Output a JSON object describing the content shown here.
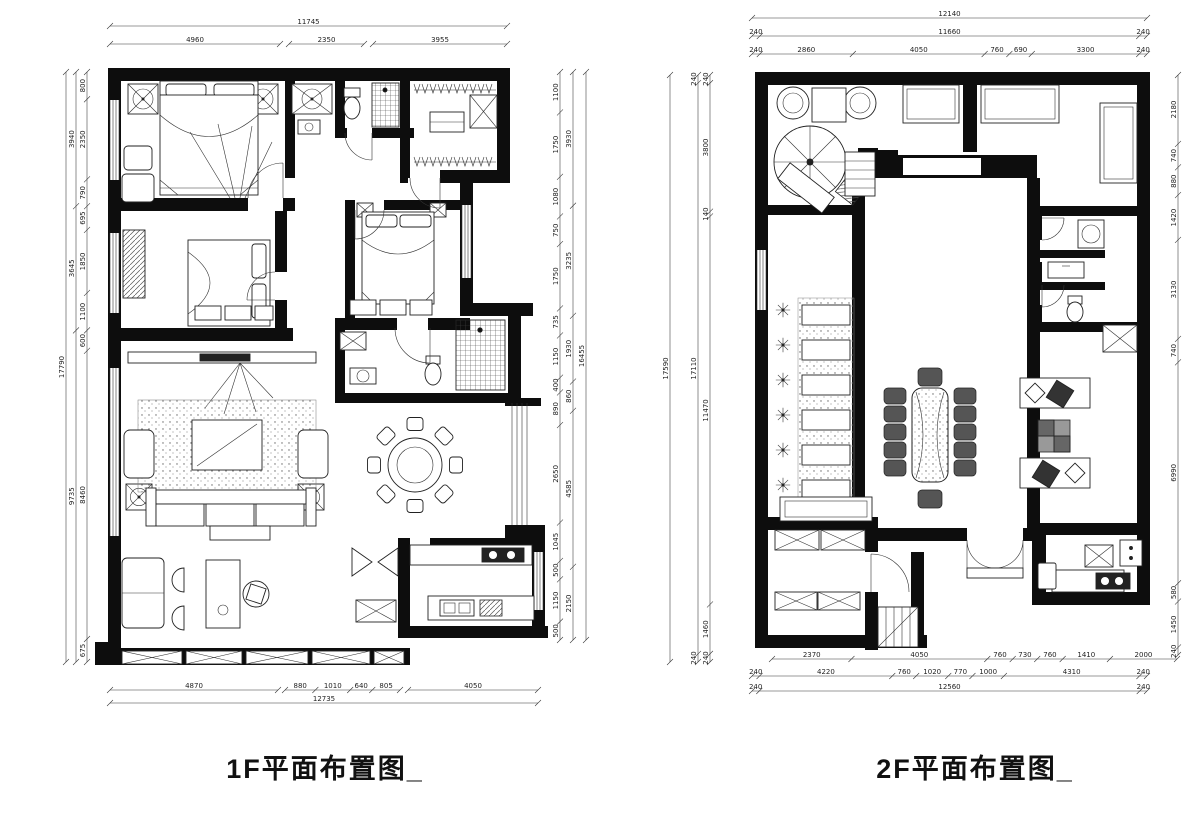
{
  "canvas": {
    "width": 1200,
    "height": 815,
    "background": "#ffffff",
    "ink": "#0d0d0d"
  },
  "plans": [
    {
      "id": "f1",
      "title": "1F平面布置图_",
      "dimension_chains": {
        "top": [
          {
            "y": 26,
            "a": 110,
            "b": 507,
            "labels": [
              "11745"
            ]
          },
          {
            "y": 44,
            "a": 110,
            "b": 280,
            "labels": [
              "4960"
            ]
          },
          {
            "y": 44,
            "a": 289,
            "b": 364,
            "labels": [
              "2350"
            ]
          },
          {
            "y": 44,
            "a": 373,
            "b": 507,
            "labels": [
              "3955"
            ]
          }
        ],
        "bottom": [
          {
            "y": 690,
            "a": 110,
            "b": 278,
            "labels": [
              "4870"
            ]
          },
          {
            "y": 690,
            "a": 285,
            "b": 400,
            "labels": [
              "880",
              "1010",
              "640",
              "805"
            ]
          },
          {
            "y": 690,
            "a": 408,
            "b": 538,
            "labels": [
              "4050"
            ]
          },
          {
            "y": 703,
            "a": 110,
            "b": 538,
            "labels": [
              "12735"
            ]
          }
        ],
        "left": [
          {
            "x": 66,
            "a": 72,
            "b": 662,
            "labels": [
              "17790"
            ]
          },
          {
            "x": 76,
            "a": 72,
            "b": 662,
            "labels": [
              "3940",
              "3645",
              "9735"
            ]
          },
          {
            "x": 87,
            "a": 72,
            "b": 662,
            "labels": [
              "800",
              "2350",
              "790",
              "695",
              "1850",
              "1100",
              "600",
              "8460",
              "675"
            ]
          }
        ],
        "right": [
          {
            "x": 560,
            "a": 72,
            "b": 640,
            "labels": [
              "1100",
              "1750",
              "1080",
              "750",
              "1750",
              "735",
              "1150",
              "400",
              "890",
              "2650",
              "1045",
              "500",
              "1150",
              "500"
            ]
          },
          {
            "x": 573,
            "a": 72,
            "b": 640,
            "labels": [
              "3930",
              "3235",
              "1930",
              "860",
              "4585",
              "2150"
            ]
          },
          {
            "x": 586,
            "a": 72,
            "b": 640,
            "labels": [
              "16455"
            ]
          }
        ]
      }
    },
    {
      "id": "f2",
      "title": "2F平面布置图_",
      "dimension_chains": {
        "top": [
          {
            "y": 18,
            "a": 752,
            "b": 1147,
            "labels": [
              "12140"
            ]
          },
          {
            "y": 36,
            "a": 752,
            "b": 1147,
            "labels": [
              "240",
              "11660",
              "240"
            ]
          },
          {
            "y": 54,
            "a": 752,
            "b": 1147,
            "labels": [
              "240",
              "2860",
              "4050",
              "760",
              "690",
              "3300",
              "240"
            ]
          }
        ],
        "bottom": [
          {
            "y": 659,
            "a": 772,
            "b": 1177,
            "labels": [
              "2370",
              "4050",
              "760",
              "730",
              "760",
              "1410",
              "2000"
            ]
          },
          {
            "y": 676,
            "a": 752,
            "b": 1147,
            "labels": [
              "240",
              "4220",
              "760",
              "1020",
              "770",
              "1000",
              "4310",
              "240"
            ]
          },
          {
            "y": 691,
            "a": 752,
            "b": 1147,
            "labels": [
              "240",
              "12560",
              "240"
            ]
          }
        ],
        "left": [
          {
            "x": 670,
            "a": 75,
            "b": 662,
            "labels": [
              "17590"
            ]
          },
          {
            "x": 698,
            "a": 75,
            "b": 662,
            "labels": [
              "240",
              "17110",
              "240"
            ]
          },
          {
            "x": 710,
            "a": 75,
            "b": 662,
            "labels": [
              "240",
              "3800",
              "140",
              "11470",
              "1460",
              "240"
            ]
          }
        ],
        "right": [
          {
            "x": 1178,
            "a": 75,
            "b": 655,
            "labels": [
              "2180",
              "740",
              "880",
              "1420",
              "3130",
              "740",
              "6990",
              "580",
              "1450",
              "240"
            ]
          }
        ]
      }
    }
  ]
}
